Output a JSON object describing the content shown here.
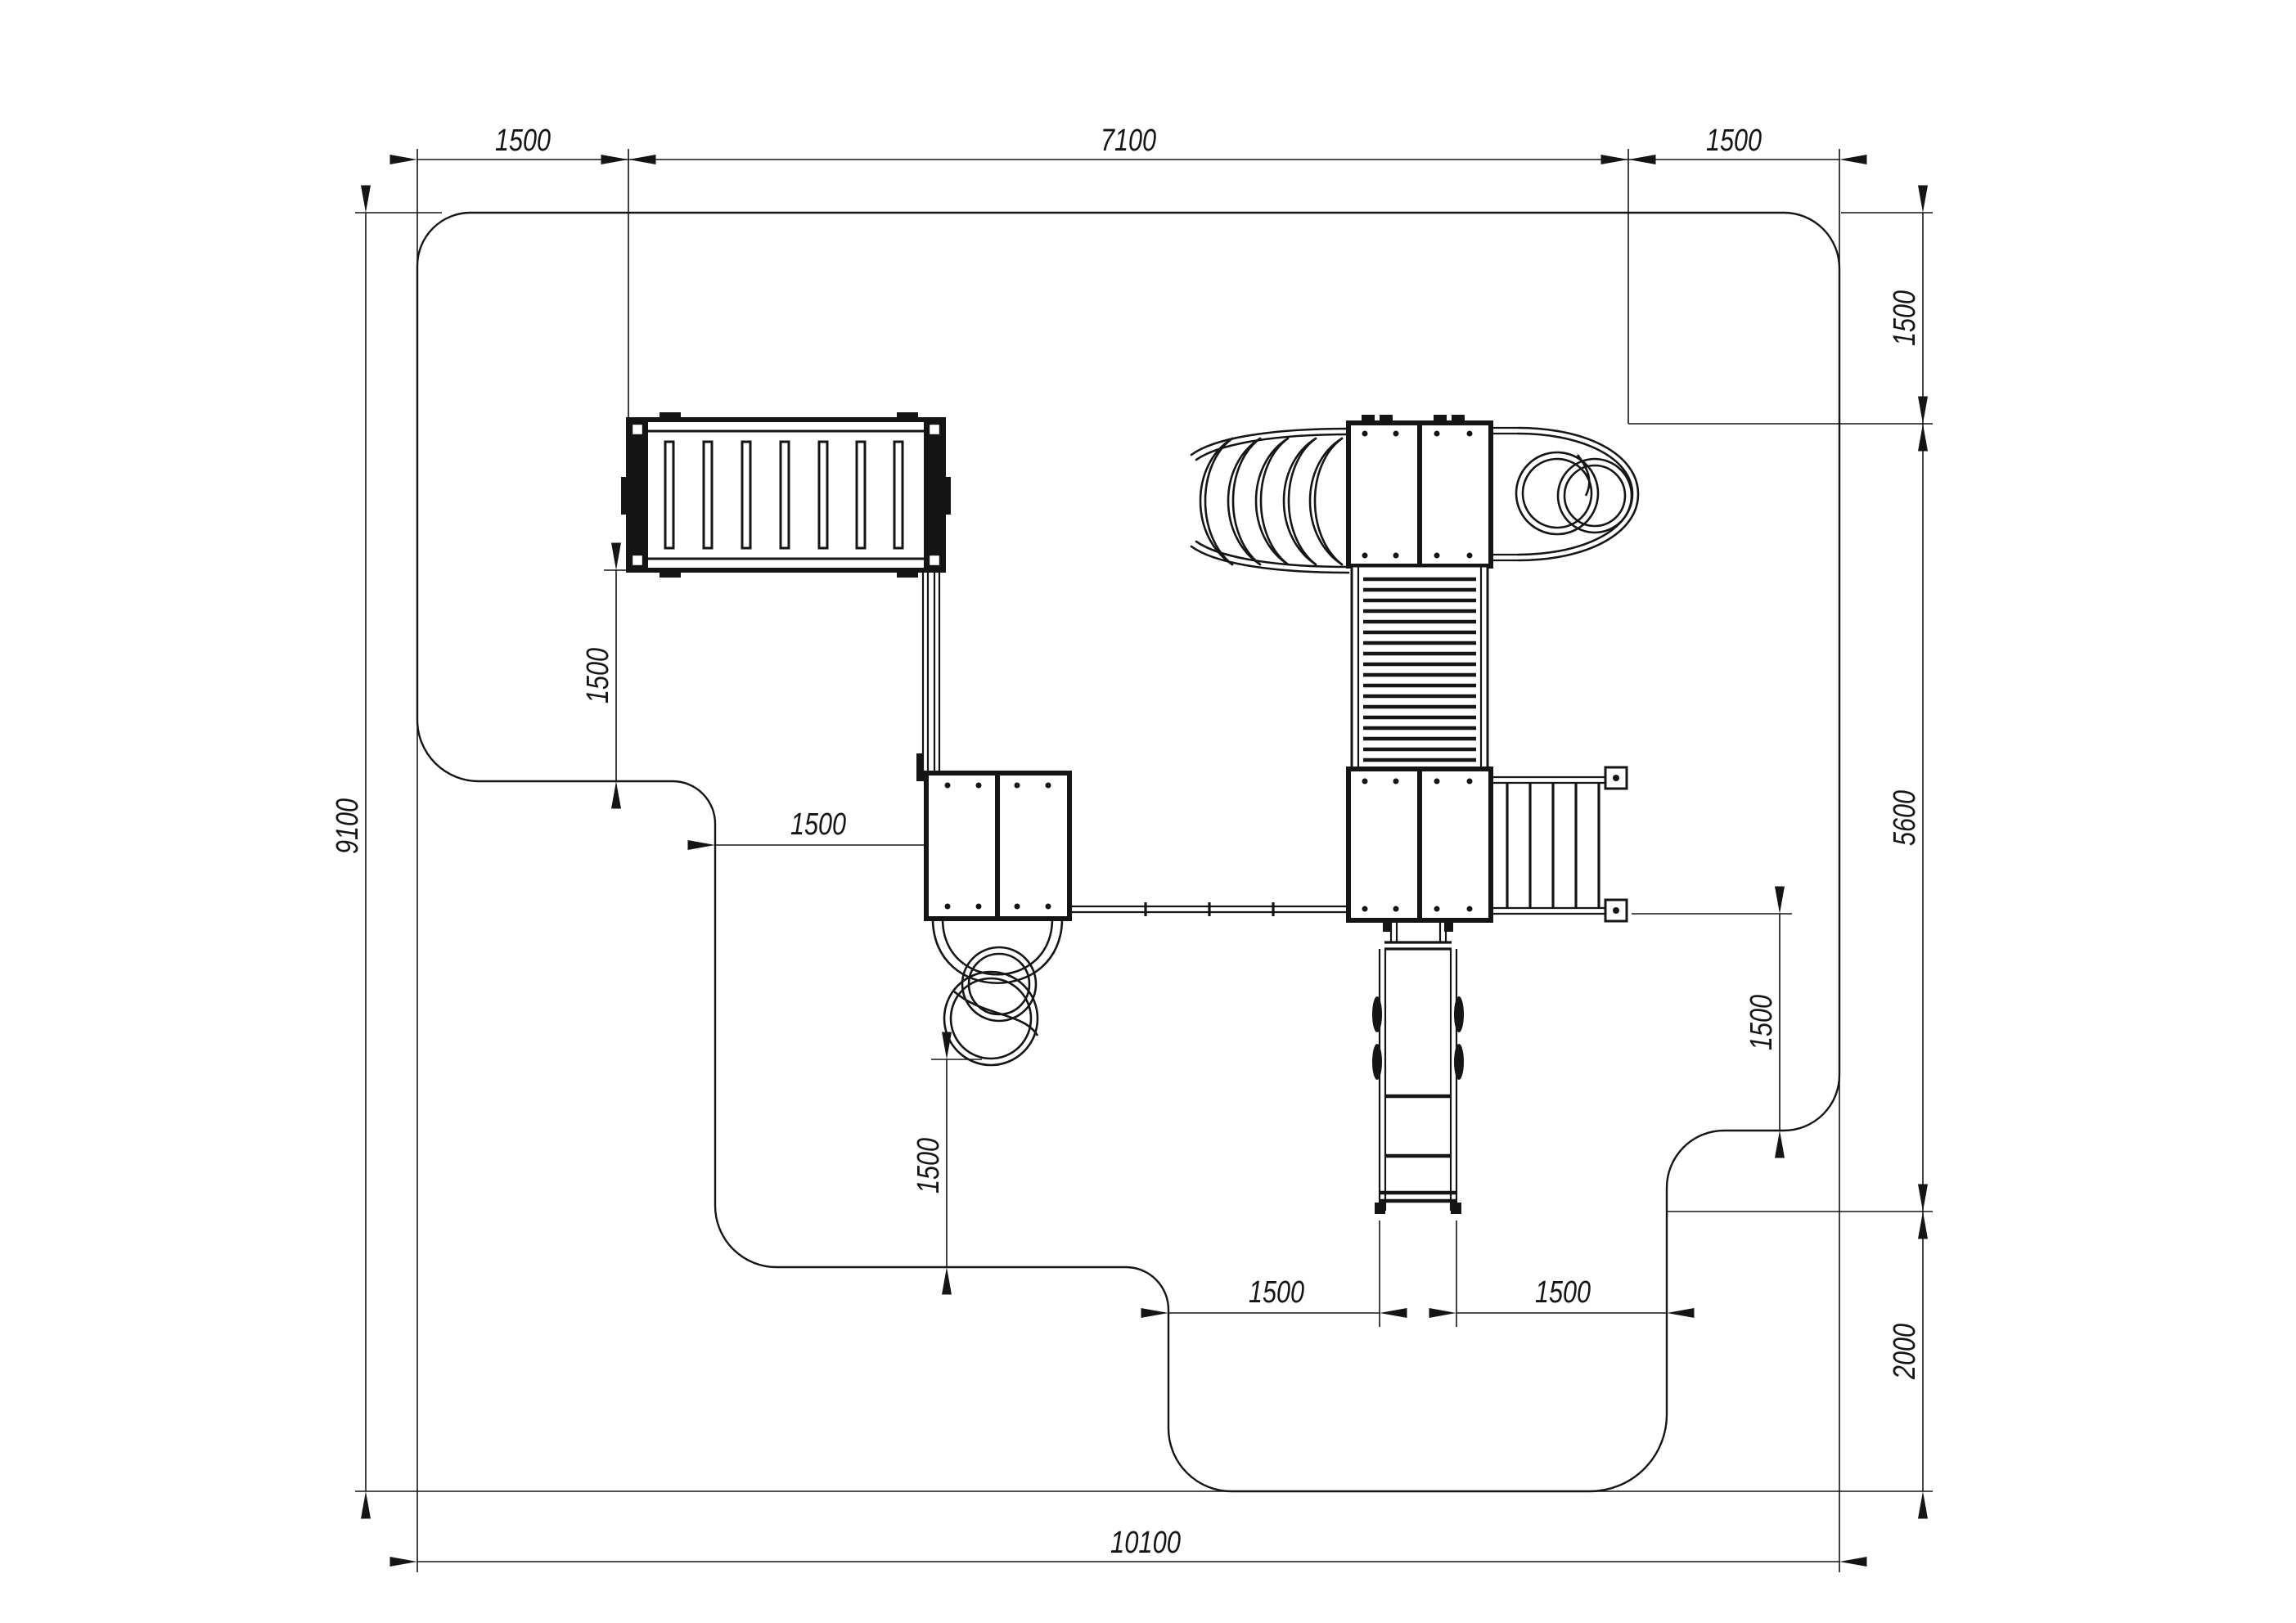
{
  "drawing": {
    "type": "playground-equipment-safety-zone-plan",
    "line_color": "#151515",
    "background_color": "#ffffff",
    "dims": {
      "top": [
        {
          "id": "zone-left-offset",
          "value": "1500"
        },
        {
          "id": "equipment-width",
          "value": "7100"
        },
        {
          "id": "zone-right-offset",
          "value": "1500"
        }
      ],
      "left": [
        {
          "id": "zone-height",
          "value": "9100"
        }
      ],
      "right": [
        {
          "id": "corner-clearance-height",
          "value": "1500"
        },
        {
          "id": "right-middle-height",
          "value": "5600"
        },
        {
          "id": "right-bottom-height",
          "value": "2000"
        }
      ],
      "bottom": [
        {
          "id": "zone-width",
          "value": "10100"
        }
      ],
      "internal": [
        {
          "id": "bridge-clearance",
          "value": "1500"
        },
        {
          "id": "platform-left-clearance",
          "value": "1500"
        },
        {
          "id": "tube-slide-clearance",
          "value": "1500"
        },
        {
          "id": "stairway-clearance",
          "value": "1500"
        },
        {
          "id": "slide-left-clearance",
          "value": "1500"
        },
        {
          "id": "slide-right-clearance",
          "value": "1500"
        }
      ]
    }
  }
}
